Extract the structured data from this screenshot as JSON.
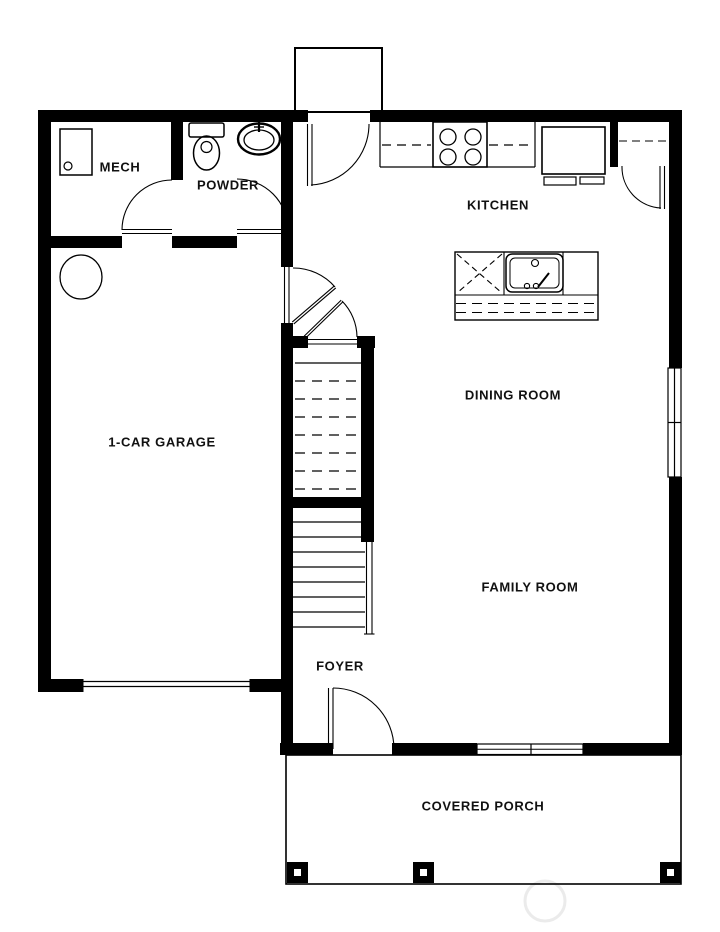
{
  "colors": {
    "background": "#ffffff",
    "walls": "#000000",
    "labels": "#111111"
  },
  "rooms": {
    "mech": {
      "label": "MECH"
    },
    "powder": {
      "label": "POWDER"
    },
    "kitchen": {
      "label": "KITCHEN"
    },
    "dining": {
      "label": "DINING ROOM"
    },
    "garage": {
      "label": "1-CAR GARAGE"
    },
    "family": {
      "label": "FAMILY ROOM"
    },
    "foyer": {
      "label": "FOYER"
    },
    "porch": {
      "label": "COVERED PORCH"
    }
  }
}
